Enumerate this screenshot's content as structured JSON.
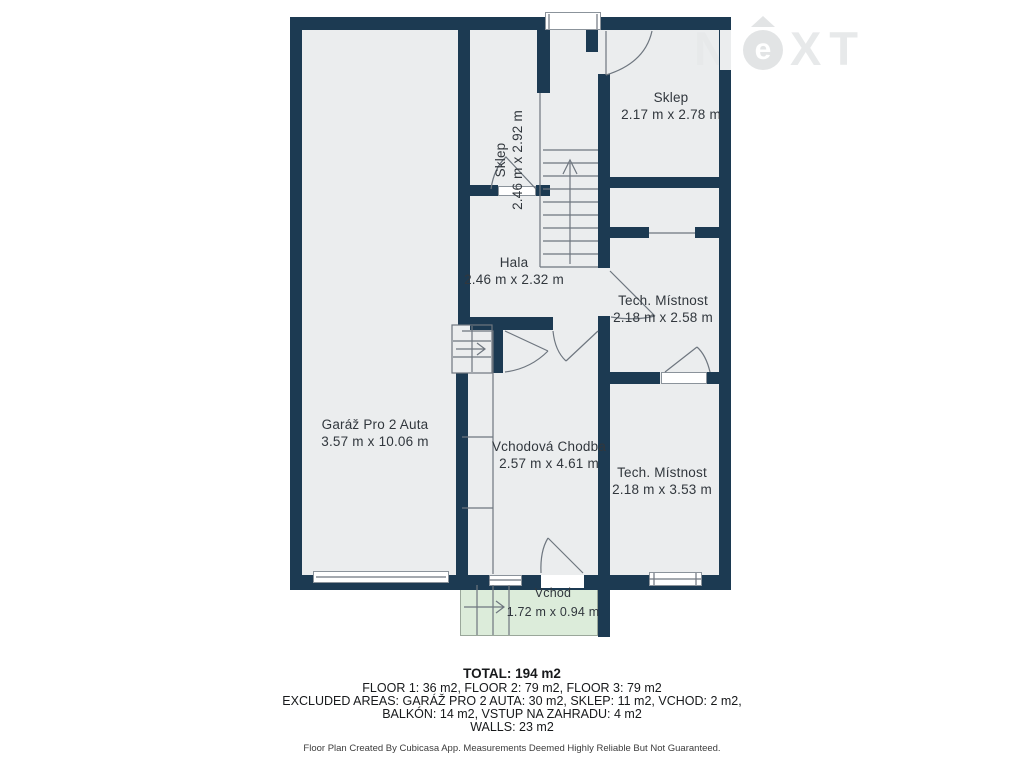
{
  "watermark": {
    "n": "N",
    "e": "e",
    "xt": "XT"
  },
  "rooms": {
    "garage": {
      "name": "Garáž Pro 2 Auta",
      "dims": "3.57 m x 10.06 m"
    },
    "sklep1": {
      "name": "Sklep",
      "dims": "2.46 m x 2.92 m"
    },
    "sklep2": {
      "name": "Sklep",
      "dims": "2.17 m x 2.78 m"
    },
    "hala": {
      "name": "Hala",
      "dims": "2.46 m x 2.32 m"
    },
    "tech1": {
      "name": "Tech. Místnost",
      "dims": "2.18 m x 2.58 m"
    },
    "tech2": {
      "name": "Tech. Místnost",
      "dims": "2.18 m x 3.53 m"
    },
    "chodba": {
      "name": "Vchodová Chodba",
      "dims": "2.57 m x 4.61 m"
    },
    "vchod": {
      "name": "Vchod",
      "dims": "1.72 m x 0.94 m"
    }
  },
  "summary": {
    "total": "TOTAL: 194 m2",
    "floors": "FLOOR 1: 36 m2, FLOOR 2: 79 m2, FLOOR 3: 79 m2",
    "excluded1": "EXCLUDED AREAS: GARÁŽ PRO 2 AUTA: 30 m2, SKLEP: 11 m2, VCHOD: 2 m2,",
    "excluded2": "BALKÓN: 14 m2, VSTUP NA ZAHRADU: 4 m2",
    "walls": "WALLS: 23 m2",
    "disclaimer": "Floor Plan Created By Cubicasa App. Measurements Deemed Highly Reliable But Not Guaranteed."
  },
  "colors": {
    "wall": "#1c3a52",
    "floor": "#ebedee",
    "entry_green": "#dcecda"
  }
}
